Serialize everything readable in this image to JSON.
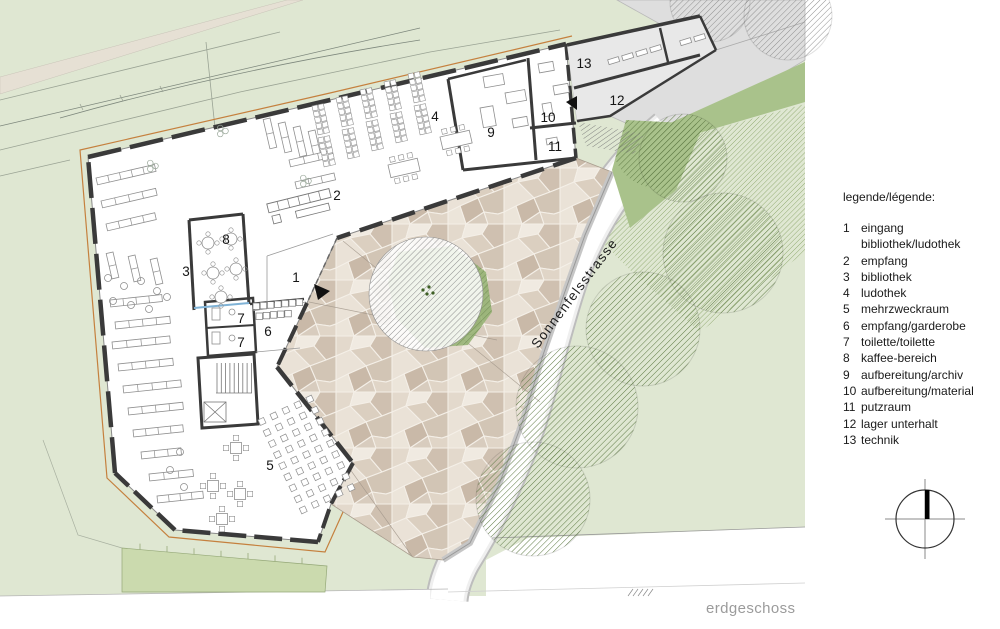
{
  "page": {
    "floor_label": "erdgeschoss"
  },
  "legend": {
    "heading": "legende/légende:",
    "items": [
      {
        "num": "1",
        "label": "eingang bibliothek/ludothek"
      },
      {
        "num": "2",
        "label": "empfang"
      },
      {
        "num": "3",
        "label": "bibliothek"
      },
      {
        "num": "4",
        "label": "ludothek"
      },
      {
        "num": "5",
        "label": "mehrzweckraum"
      },
      {
        "num": "6",
        "label": "empfang/garderobe"
      },
      {
        "num": "7",
        "label": "toilette/toilette"
      },
      {
        "num": "8",
        "label": "kaffee-bereich"
      },
      {
        "num": "9",
        "label": "aufbereitung/archiv"
      },
      {
        "num": "10",
        "label": "aufbereitung/material"
      },
      {
        "num": "11",
        "label": "putzraum"
      },
      {
        "num": "12",
        "label": "lager unterhalt"
      },
      {
        "num": "13",
        "label": "technik"
      }
    ]
  },
  "plan": {
    "street_label": "Sonnenfelsstrasse",
    "room_labels": [
      {
        "num": "1",
        "x": 296,
        "y": 282
      },
      {
        "num": "2",
        "x": 337,
        "y": 200
      },
      {
        "num": "3",
        "x": 186,
        "y": 276
      },
      {
        "num": "4",
        "x": 435,
        "y": 121
      },
      {
        "num": "5",
        "x": 270,
        "y": 470
      },
      {
        "num": "6",
        "x": 268,
        "y": 336
      },
      {
        "num": "7",
        "x": 241,
        "y": 323
      },
      {
        "num": "7",
        "x": 241,
        "y": 347
      },
      {
        "num": "8",
        "x": 226,
        "y": 244
      },
      {
        "num": "9",
        "x": 491,
        "y": 137
      },
      {
        "num": "10",
        "x": 548,
        "y": 122
      },
      {
        "num": "11",
        "x": 555,
        "y": 151
      },
      {
        "num": "12",
        "x": 617,
        "y": 105
      },
      {
        "num": "13",
        "x": 584,
        "y": 68
      }
    ],
    "colors": {
      "site_green": "#dfe7d2",
      "lawn_green": "#a9c28b",
      "garden_green": "#cbdaae",
      "paving_base": "#d9cec3",
      "driveway_gray": "#dedede",
      "wall_dark": "#3a3a3a",
      "parcel_orange": "#c5803e",
      "street_white": "#ffffff",
      "label_gray": "#9b9b9b"
    }
  }
}
